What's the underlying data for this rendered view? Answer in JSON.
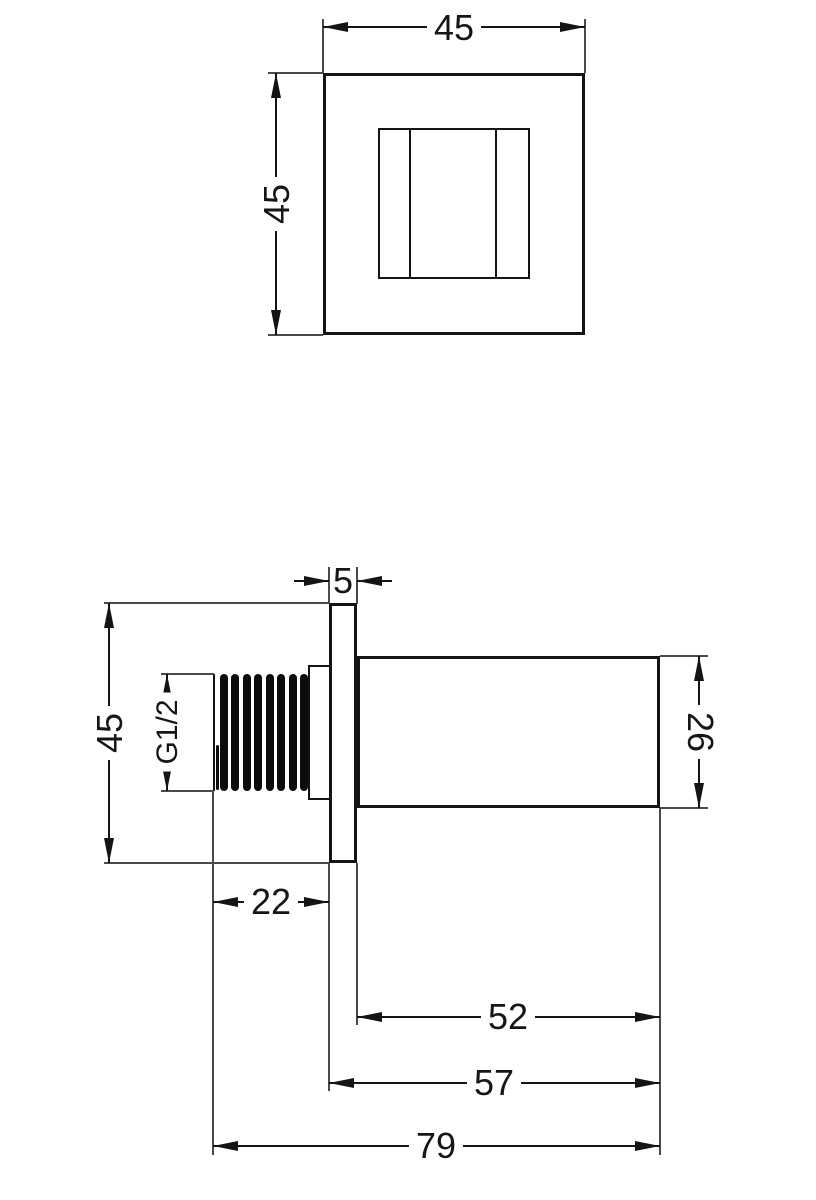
{
  "front_view": {
    "width": "45",
    "height": "45"
  },
  "side_view": {
    "plate_thickness": "5",
    "plate_height": "45",
    "thread_spec": "G1/2",
    "body_height": "26",
    "thread_length": "22",
    "body_length": "52",
    "plate_and_body_length": "57",
    "overall_length": "79"
  },
  "style": {
    "line_color": "#141414",
    "extension_line_color": "#4a4a4a",
    "background_color": "#ffffff"
  }
}
